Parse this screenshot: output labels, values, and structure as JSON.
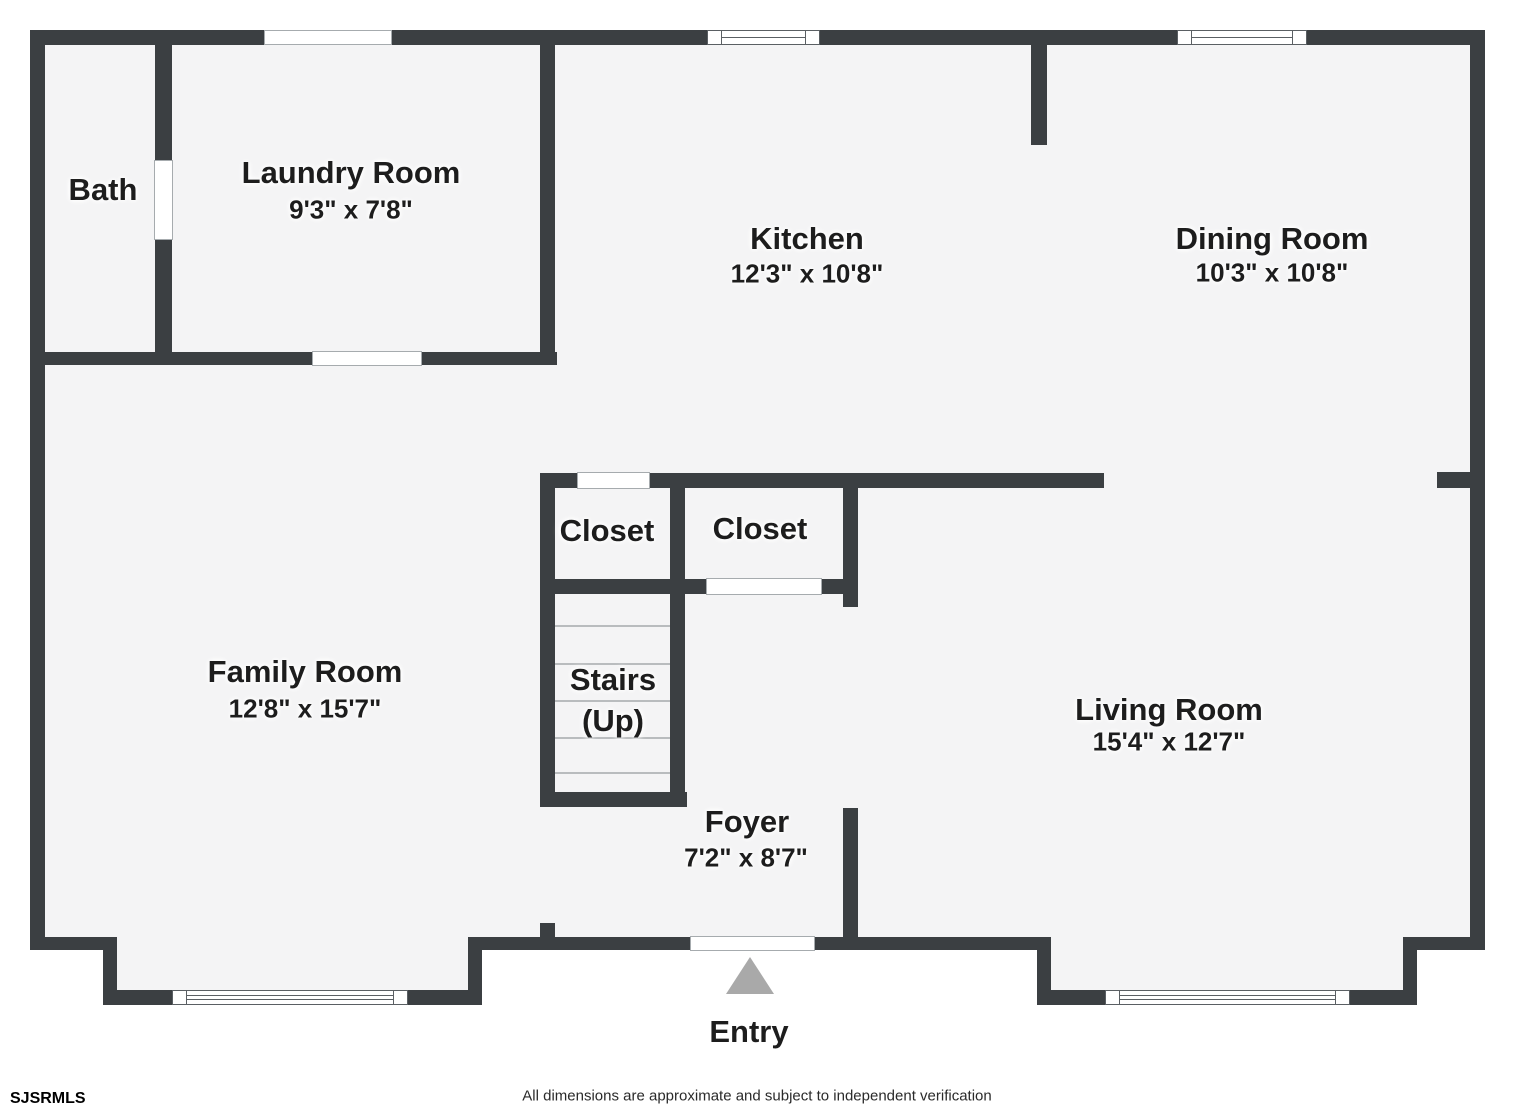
{
  "meta": {
    "width": 1515,
    "height": 1112,
    "type": "floor-plan"
  },
  "colors": {
    "wall": "#3b3f42",
    "floor": "#f4f4f5",
    "background": "#ffffff",
    "opening_border": "#a6abae",
    "window_border": "#5a5f63",
    "tread": "#b9bcbe",
    "entry_arrow": "#a9a9a9",
    "text": "#1d1d1d"
  },
  "rooms": [
    {
      "name": "Bath",
      "dims": ""
    },
    {
      "name": "Laundry Room",
      "dims": "9'3\" x 7'8\""
    },
    {
      "name": "Kitchen",
      "dims": "12'3\" x 10'8\""
    },
    {
      "name": "Dining Room",
      "dims": "10'3\" x 10'8\""
    },
    {
      "name": "Family Room",
      "dims": "12'8\" x 15'7\""
    },
    {
      "name": "Closet",
      "dims": ""
    },
    {
      "name": "Closet",
      "dims": ""
    },
    {
      "name": "Stairs",
      "dims": "(Up)"
    },
    {
      "name": "Living Room",
      "dims": "15'4\" x 12'7\""
    },
    {
      "name": "Foyer",
      "dims": "7'2\" x 8'7\""
    },
    {
      "name": "Entry",
      "dims": ""
    }
  ],
  "icons": {
    "entry_arrow": "up-triangle"
  },
  "footer": {
    "brand": "SJSRMLS",
    "disclaimer": "All dimensions are approximate and subject to independent verification"
  }
}
